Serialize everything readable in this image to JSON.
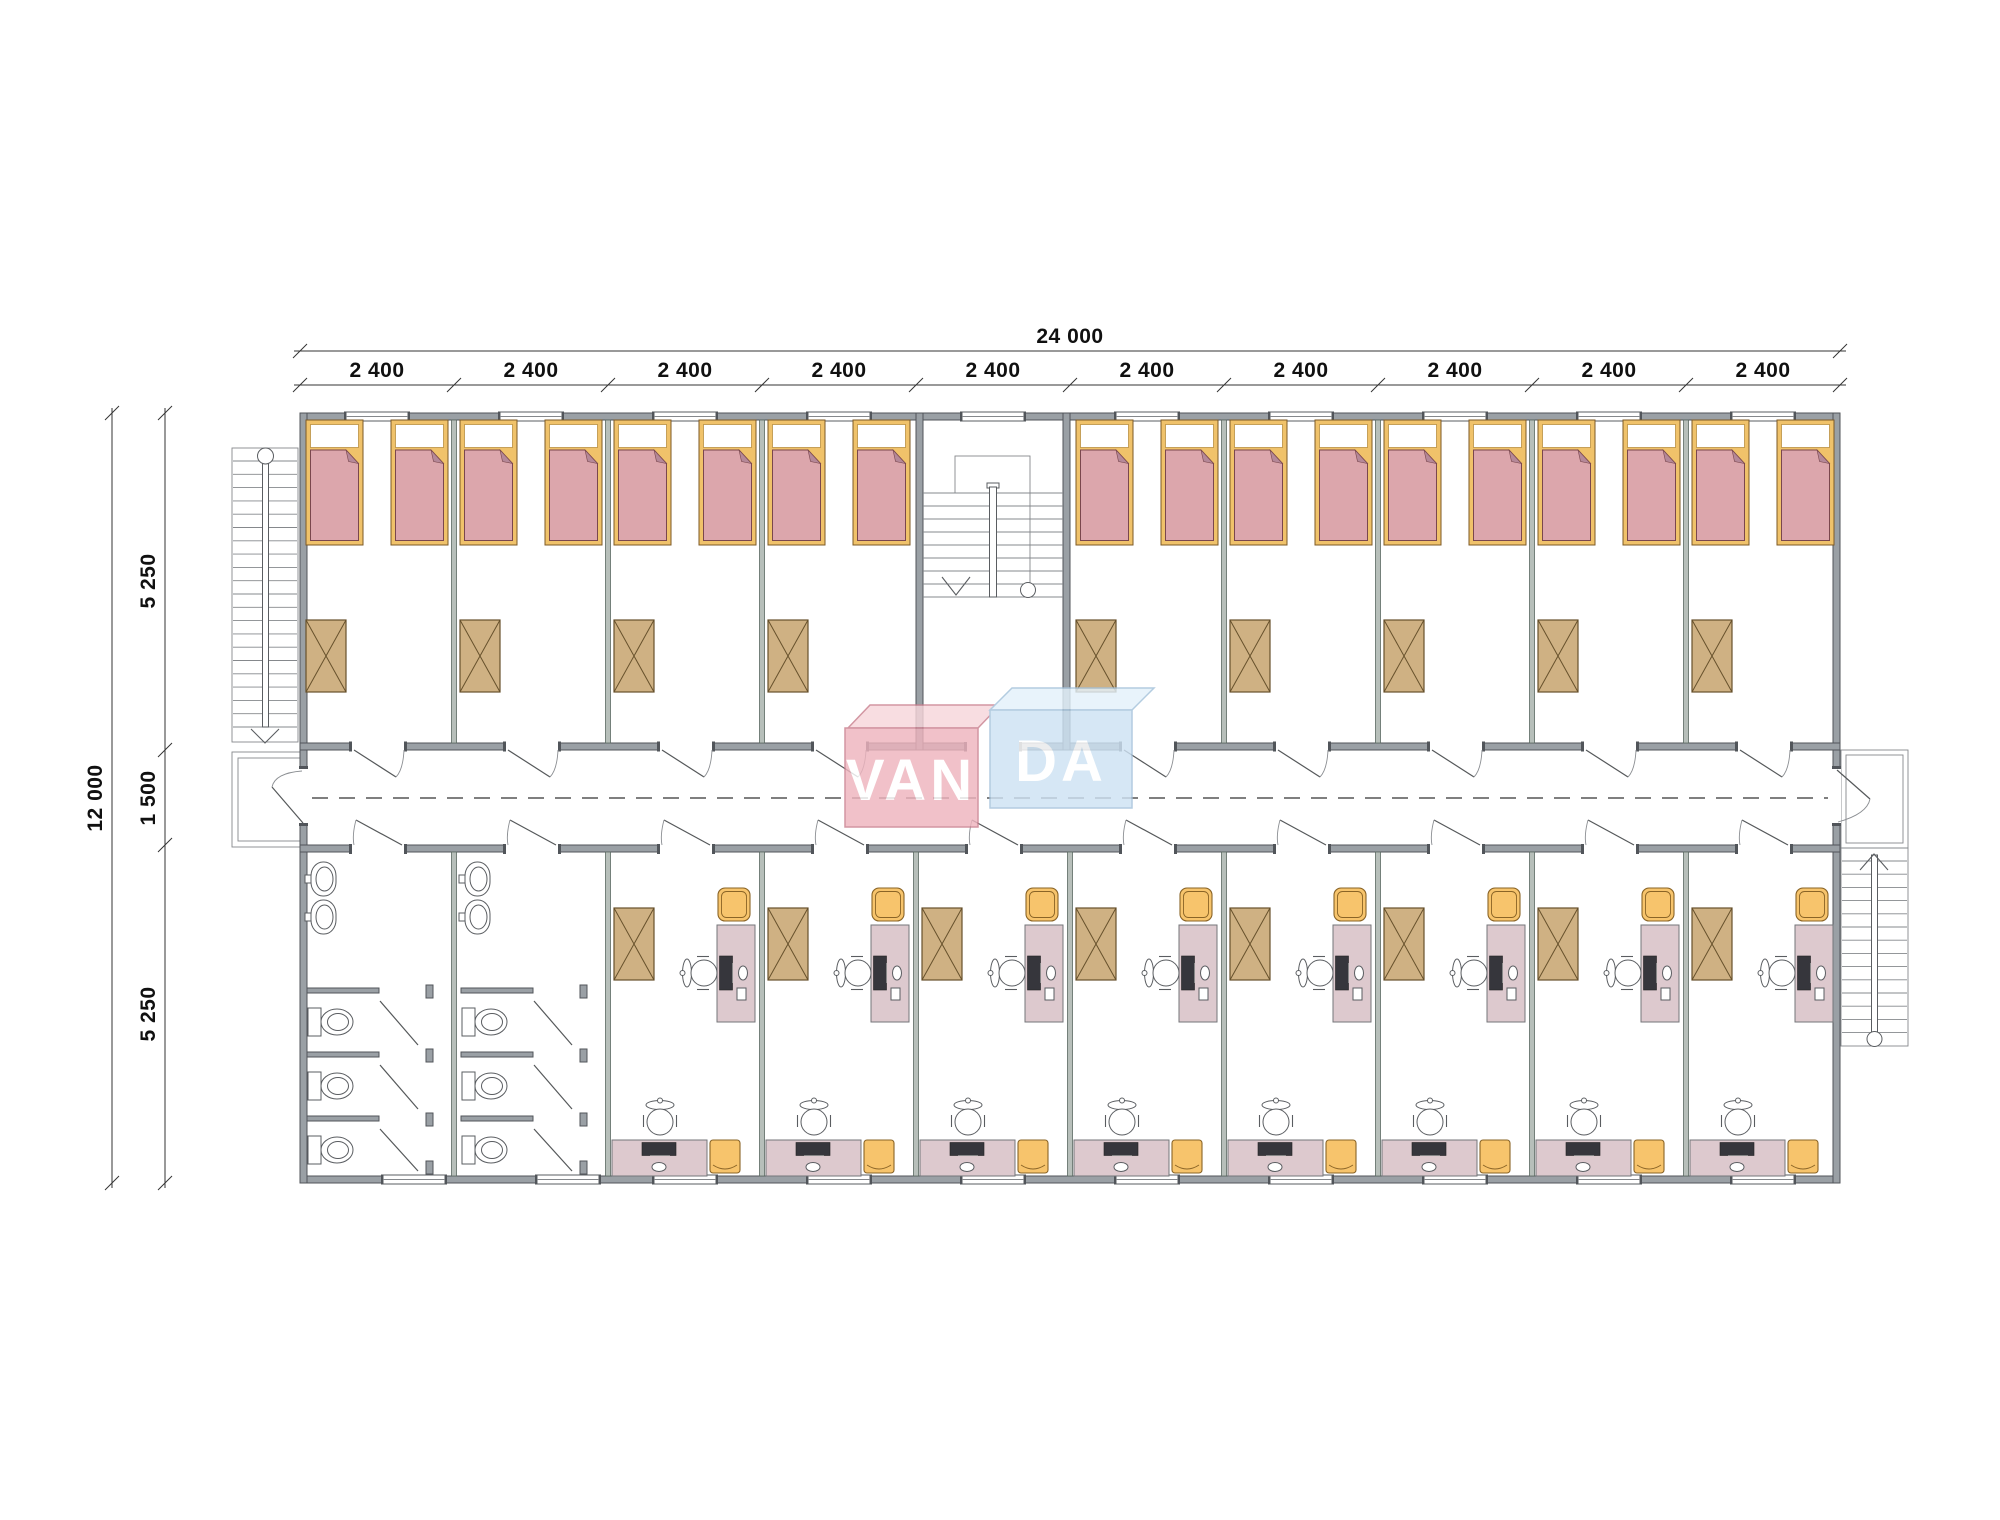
{
  "title": "VANDA modular dormitory floor plan",
  "brand": {
    "name": "VANDA",
    "left": "VAN",
    "right": "DA"
  },
  "dimensions": {
    "total_width": "24 000",
    "module_width": "2 400",
    "modules_count": 10,
    "total_depth": "12 000",
    "top_room_depth": "5 250",
    "corridor_width": "1 500",
    "bottom_room_depth": "5 250"
  },
  "inventory": {
    "bedroom_modules": 9,
    "beds": 18,
    "office_modules": 8,
    "desks": 16,
    "wardrobes": 17,
    "bathrooms": 2,
    "toilets": 6,
    "sinks": 4,
    "staircases": 3,
    "entrances": 2
  },
  "colors": {
    "wall-fill": "#9aa0a5",
    "partition-fill": "#b7bfba",
    "bed-frame": "#f0c26a",
    "blanket": "#dca6ac",
    "fold": "#b58898",
    "wardrobe": "#cfb183",
    "desk": "#ddc9ce",
    "orange": "#f7c46c",
    "monitor": "#36363c",
    "logo-pink": "#eeb4be",
    "logo-pink-top": "#f7d6db",
    "logo-blue": "#cee2f3",
    "logo-blue-top": "#e3f1fb"
  }
}
